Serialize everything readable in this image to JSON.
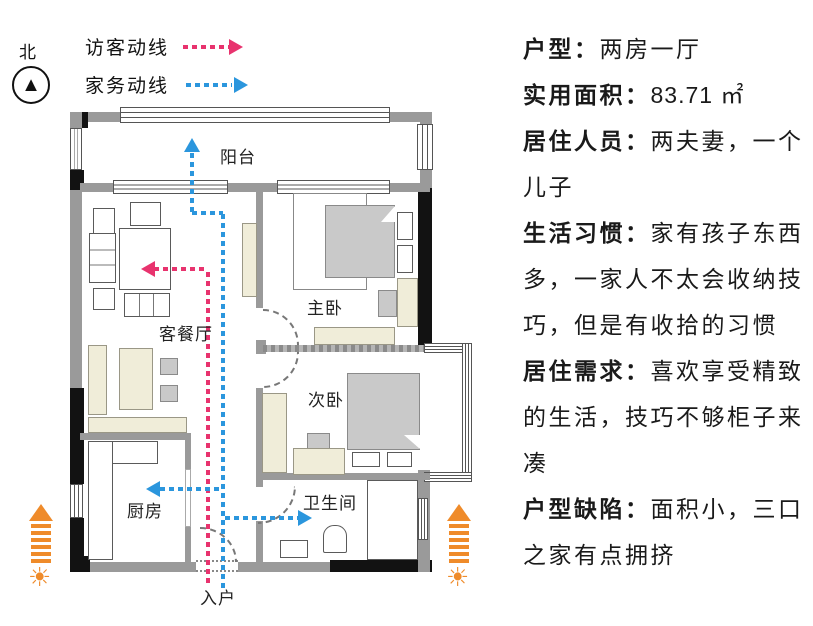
{
  "compass": {
    "north_label": "北"
  },
  "legend": [
    {
      "label": "访客动线",
      "color": "#e8336e"
    },
    {
      "label": "家务动线",
      "color": "#2b96dd"
    }
  ],
  "floorplan": {
    "rooms": [
      {
        "id": "balcony",
        "label": "阳台"
      },
      {
        "id": "living",
        "label": "客餐厅"
      },
      {
        "id": "master",
        "label": "主卧"
      },
      {
        "id": "second",
        "label": "次卧"
      },
      {
        "id": "kitchen",
        "label": "厨房"
      },
      {
        "id": "bathroom",
        "label": "卫生间"
      },
      {
        "id": "entry",
        "label": "入户"
      }
    ],
    "sunlight_color": "#ef8b2a"
  },
  "info": [
    {
      "label": "户型：",
      "text": "两房一厅"
    },
    {
      "label": "实用面积：",
      "text": "83.71 ㎡"
    },
    {
      "label": "居住人员：",
      "text": "两夫妻，一个儿子"
    },
    {
      "label": "生活习惯：",
      "text": "家有孩子东西多，一家人不太会收纳技巧，但是有收拾的习惯"
    },
    {
      "label": "居住需求：",
      "text": "喜欢享受精致的生活，技巧不够柜子来凑"
    },
    {
      "label": "户型缺陷：",
      "text": "面积小，三口之家有点拥挤"
    }
  ]
}
